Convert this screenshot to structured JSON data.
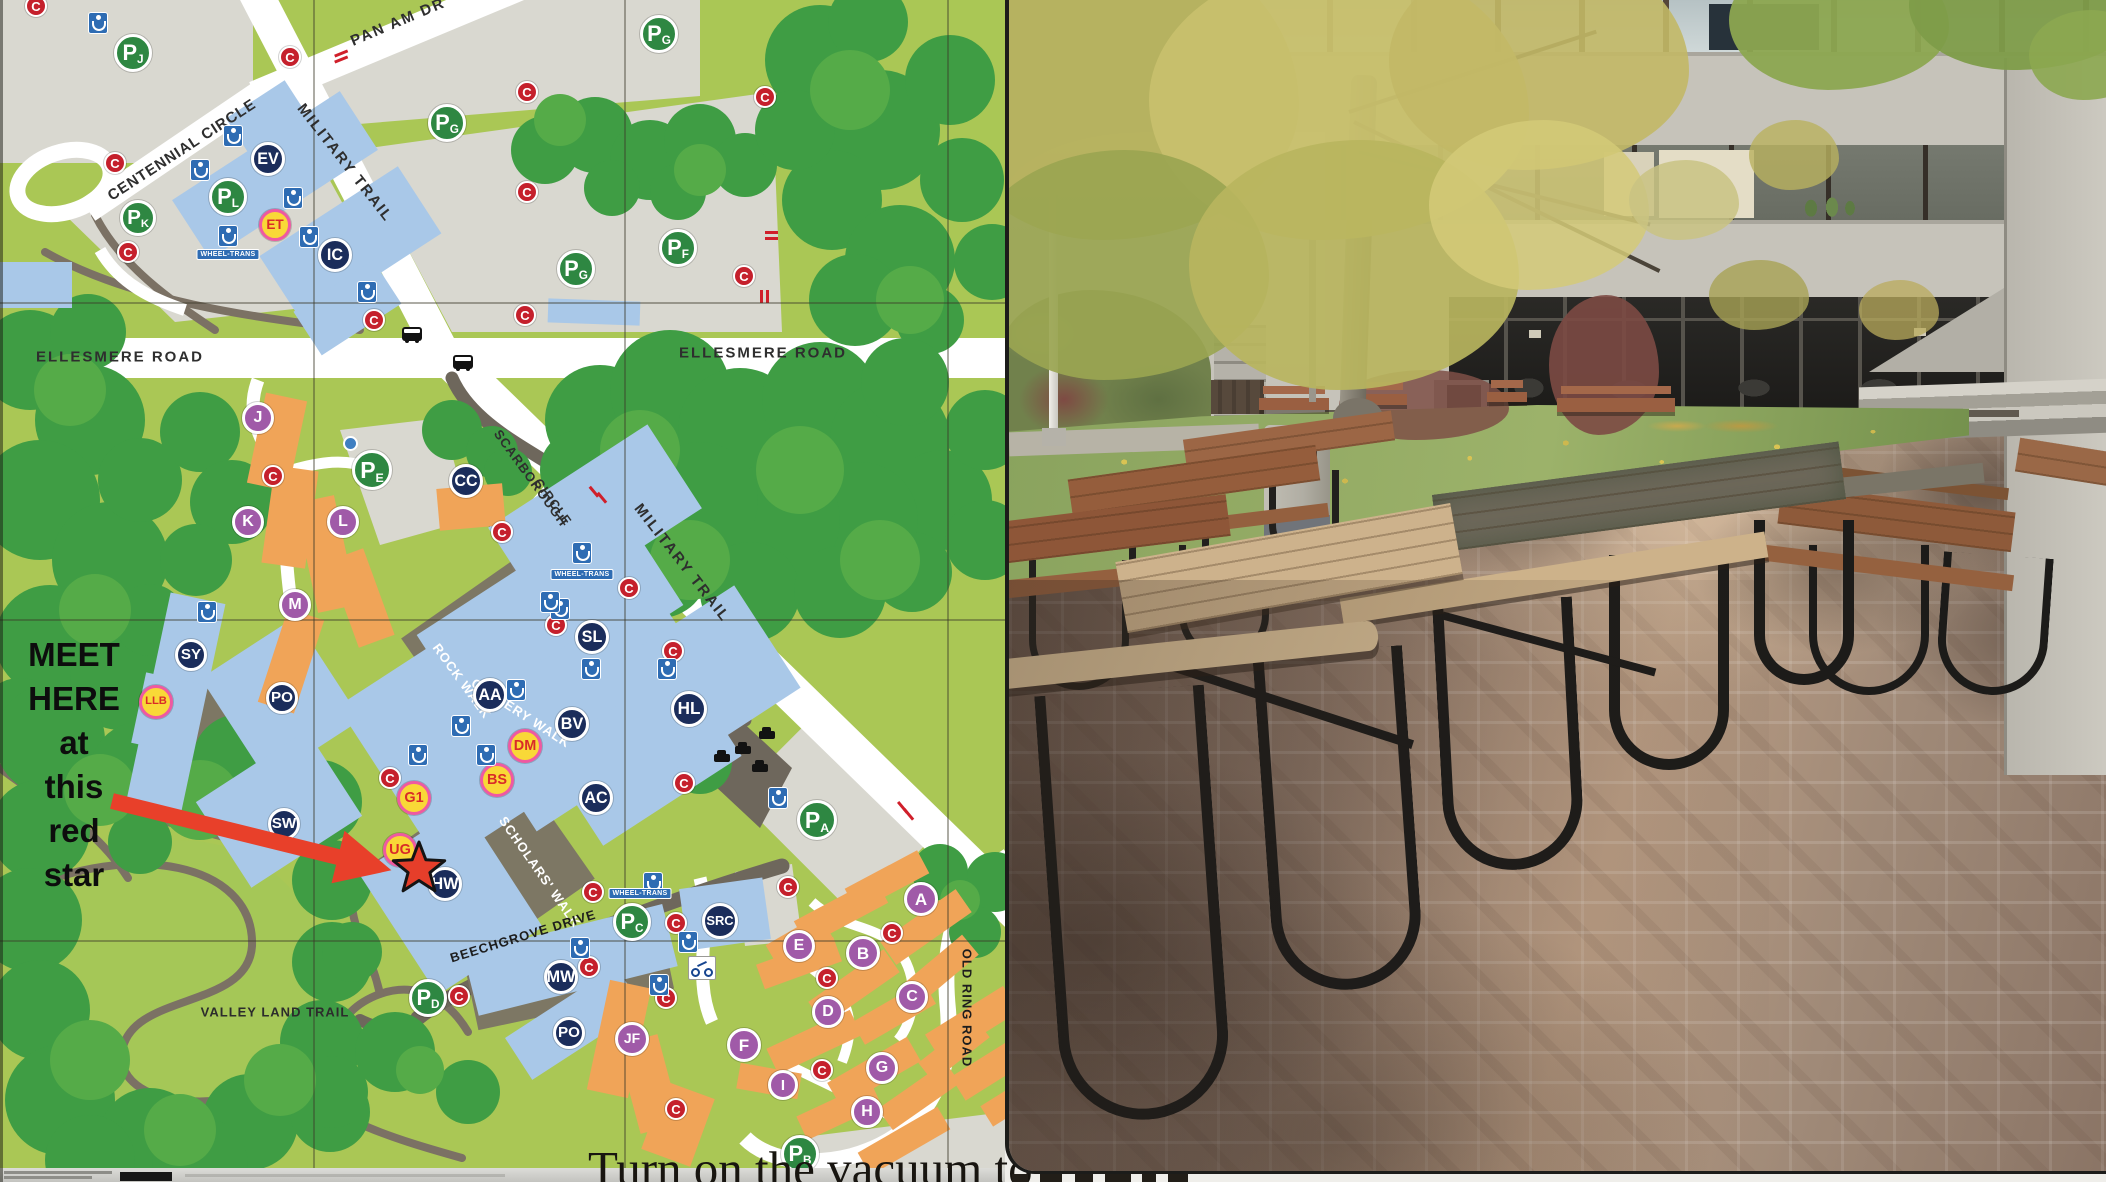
{
  "page": {
    "width": 2106,
    "height": 1182
  },
  "map": {
    "note_lines": [
      "MEET",
      "HERE",
      "at",
      "this",
      "red",
      "star"
    ],
    "road_labels": [
      {
        "text": "PAN AM DR",
        "x": 398,
        "y": 22,
        "rot": -23,
        "size": 15,
        "color": "#2e2e2e",
        "ls": 2
      },
      {
        "text": "CENTENNIAL CIRCLE",
        "x": 182,
        "y": 150,
        "rot": -33,
        "size": 15,
        "color": "#2e2e2e",
        "ls": 1
      },
      {
        "text": "MILITARY TRAIL",
        "x": 345,
        "y": 163,
        "rot": 52,
        "size": 15,
        "color": "#2e2e2e",
        "ls": 2
      },
      {
        "text": "MILITARY TRAIL",
        "x": 682,
        "y": 563,
        "rot": 52,
        "size": 15,
        "color": "#2e2e2e",
        "ls": 2
      },
      {
        "text": "ELLESMERE ROAD",
        "x": 120,
        "y": 357,
        "rot": 0,
        "size": 15,
        "color": "#2e2e2e",
        "ls": 2
      },
      {
        "text": "ELLESMERE ROAD",
        "x": 763,
        "y": 353,
        "rot": 0,
        "size": 15,
        "color": "#2e2e2e",
        "ls": 2
      },
      {
        "text": "SCARBOROUGH",
        "x": 531,
        "y": 478,
        "rot": 54,
        "size": 13,
        "color": "#2e2e2e",
        "ls": 1
      },
      {
        "text": "CIRCLE",
        "x": 553,
        "y": 502,
        "rot": 54,
        "size": 13,
        "color": "#2e2e2e",
        "ls": 1
      },
      {
        "text": "ROCK WALK",
        "x": 462,
        "y": 681,
        "rot": 54,
        "size": 13,
        "color": "#ffffff",
        "ls": 1
      },
      {
        "text": "GALLERY WALK",
        "x": 521,
        "y": 713,
        "rot": 33,
        "size": 13,
        "color": "#ffffff",
        "ls": 1
      },
      {
        "text": "SCHOLARS' WALK",
        "x": 540,
        "y": 872,
        "rot": 55,
        "size": 13,
        "color": "#ffffff",
        "ls": 1
      },
      {
        "text": "BEECHGROVE DRIVE",
        "x": 523,
        "y": 936,
        "rot": -17,
        "size": 13,
        "color": "#1d1d1d",
        "ls": 1
      },
      {
        "text": "OLD RING ROAD",
        "x": 967,
        "y": 1008,
        "rot": 90,
        "size": 13,
        "color": "#1d1d1d",
        "ls": 1
      },
      {
        "text": "VALLEY LAND TRAIL",
        "x": 275,
        "y": 1012,
        "rot": 0,
        "size": 13,
        "color": "#2c2c2c",
        "ls": 1
      }
    ],
    "markers": {
      "navy": [
        {
          "label": "EV",
          "x": 268,
          "y": 159,
          "r": 17
        },
        {
          "label": "IC",
          "x": 335,
          "y": 255,
          "r": 17
        },
        {
          "label": "CC",
          "x": 466,
          "y": 481,
          "r": 17
        },
        {
          "label": "SL",
          "x": 592,
          "y": 637,
          "r": 17
        },
        {
          "label": "AA",
          "x": 490,
          "y": 695,
          "r": 17
        },
        {
          "label": "BV",
          "x": 572,
          "y": 724,
          "r": 17
        },
        {
          "label": "HL",
          "x": 689,
          "y": 709,
          "r": 18
        },
        {
          "label": "AC",
          "x": 596,
          "y": 798,
          "r": 17
        },
        {
          "label": "HW",
          "x": 445,
          "y": 884,
          "r": 17
        },
        {
          "label": "SY",
          "x": 191,
          "y": 655,
          "r": 16
        },
        {
          "label": "PO",
          "x": 282,
          "y": 698,
          "r": 16
        },
        {
          "label": "SW",
          "x": 284,
          "y": 824,
          "r": 16
        },
        {
          "label": "MW",
          "x": 561,
          "y": 977,
          "r": 17
        },
        {
          "label": "PO",
          "x": 569,
          "y": 1033,
          "r": 16
        },
        {
          "label": "SRC",
          "x": 720,
          "y": 921,
          "r": 18
        }
      ],
      "parking_letter": "P",
      "parking": [
        {
          "sub": "J",
          "x": 133,
          "y": 53,
          "r": 19
        },
        {
          "sub": "G",
          "x": 447,
          "y": 123,
          "r": 19
        },
        {
          "sub": "G",
          "x": 659,
          "y": 34,
          "r": 19
        },
        {
          "sub": "G",
          "x": 576,
          "y": 269,
          "r": 19
        },
        {
          "sub": "F",
          "x": 678,
          "y": 248,
          "r": 19
        },
        {
          "sub": "K",
          "x": 138,
          "y": 218,
          "r": 18
        },
        {
          "sub": "L",
          "x": 228,
          "y": 197,
          "r": 19
        },
        {
          "sub": "E",
          "x": 372,
          "y": 470,
          "r": 20
        },
        {
          "sub": "A",
          "x": 817,
          "y": 820,
          "r": 20
        },
        {
          "sub": "C",
          "x": 632,
          "y": 922,
          "r": 19
        },
        {
          "sub": "D",
          "x": 428,
          "y": 998,
          "r": 19
        },
        {
          "sub": "B",
          "x": 800,
          "y": 1154,
          "r": 19
        }
      ],
      "yellow": [
        {
          "label": "ET",
          "x": 275,
          "y": 225,
          "r": 16
        },
        {
          "label": "LLB",
          "x": 156,
          "y": 702,
          "r": 17
        },
        {
          "label": "DM",
          "x": 525,
          "y": 746,
          "r": 17
        },
        {
          "label": "BS",
          "x": 497,
          "y": 780,
          "r": 17
        },
        {
          "label": "G1",
          "x": 414,
          "y": 798,
          "r": 17
        },
        {
          "label": "UG",
          "x": 400,
          "y": 850,
          "r": 17
        }
      ],
      "purple": [
        {
          "label": "J",
          "x": 258,
          "y": 418,
          "r": 16
        },
        {
          "label": "K",
          "x": 248,
          "y": 522,
          "r": 16
        },
        {
          "label": "L",
          "x": 343,
          "y": 522,
          "r": 16
        },
        {
          "label": "M",
          "x": 295,
          "y": 605,
          "r": 16
        },
        {
          "label": "A",
          "x": 921,
          "y": 899,
          "r": 17
        },
        {
          "label": "B",
          "x": 863,
          "y": 953,
          "r": 17
        },
        {
          "label": "C",
          "x": 912,
          "y": 997,
          "r": 16
        },
        {
          "label": "D",
          "x": 828,
          "y": 1012,
          "r": 16
        },
        {
          "label": "E",
          "x": 799,
          "y": 946,
          "r": 16
        },
        {
          "label": "F",
          "x": 744,
          "y": 1045,
          "r": 17
        },
        {
          "label": "G",
          "x": 882,
          "y": 1068,
          "r": 16
        },
        {
          "label": "H",
          "x": 867,
          "y": 1112,
          "r": 16
        },
        {
          "label": "I",
          "x": 783,
          "y": 1085,
          "r": 15
        },
        {
          "label": "JF",
          "x": 632,
          "y": 1039,
          "r": 17
        }
      ],
      "red_c_label": "C",
      "red_c": [
        [
          36,
          6
        ],
        [
          290,
          57
        ],
        [
          115,
          163
        ],
        [
          128,
          252
        ],
        [
          374,
          320
        ],
        [
          527,
          92
        ],
        [
          527,
          192
        ],
        [
          525,
          315
        ],
        [
          765,
          97
        ],
        [
          744,
          276
        ],
        [
          273,
          476
        ],
        [
          502,
          532
        ],
        [
          556,
          625
        ],
        [
          629,
          588
        ],
        [
          673,
          651
        ],
        [
          390,
          778
        ],
        [
          684,
          783
        ],
        [
          593,
          892
        ],
        [
          676,
          923
        ],
        [
          589,
          967
        ],
        [
          459,
          996
        ],
        [
          666,
          998
        ],
        [
          676,
          1109
        ],
        [
          788,
          887
        ],
        [
          892,
          933
        ],
        [
          827,
          978
        ],
        [
          822,
          1070
        ]
      ],
      "accessibility": [
        [
          98,
          23
        ],
        [
          233,
          136
        ],
        [
          200,
          170
        ],
        [
          293,
          198
        ],
        [
          309,
          237
        ],
        [
          228,
          236
        ],
        [
          367,
          292
        ],
        [
          207,
          612
        ],
        [
          560,
          609
        ],
        [
          550,
          602
        ],
        [
          591,
          669
        ],
        [
          667,
          669
        ],
        [
          516,
          690
        ],
        [
          461,
          726
        ],
        [
          486,
          755
        ],
        [
          418,
          755
        ],
        [
          582,
          553
        ],
        [
          659,
          985
        ],
        [
          688,
          942
        ],
        [
          580,
          948
        ],
        [
          653,
          883
        ],
        [
          778,
          798
        ]
      ],
      "wheeltrans_label": "WHEEL-TRANS",
      "wheeltrans": [
        [
          228,
          249
        ],
        [
          582,
          569
        ],
        [
          640,
          888
        ]
      ],
      "bus": [
        [
          412,
          334
        ],
        [
          463,
          362
        ]
      ],
      "car": [
        [
          722,
          758
        ],
        [
          743,
          750
        ],
        [
          767,
          735
        ],
        [
          760,
          768
        ]
      ],
      "bike": [
        [
          701,
          967
        ]
      ],
      "info_dot": [
        [
          350,
          443
        ]
      ]
    },
    "colors": {
      "land": "#aac755",
      "trees": "#3f9d44",
      "lot": "#d9d8d0",
      "building_blue": "#a9c8e8",
      "residence_orange": "#f0a458",
      "navy": "#1b2d5b",
      "parking_green": "#2e8742",
      "yellow": "#f9d837",
      "yellow_ring": "#ef59a1",
      "purple": "#a05aa8",
      "red": "#c5202c",
      "arrow_red": "#e8402a"
    }
  },
  "caption": {
    "text": "Turn on the vacuum to"
  },
  "photo": {
    "alt": "Campus courtyard with picnic tables on herringbone brick paving in front of a concrete brutalist building entrance; large tree with yellow autumn foliage at left, lawn, benches and a concrete trash bin in the midground"
  }
}
